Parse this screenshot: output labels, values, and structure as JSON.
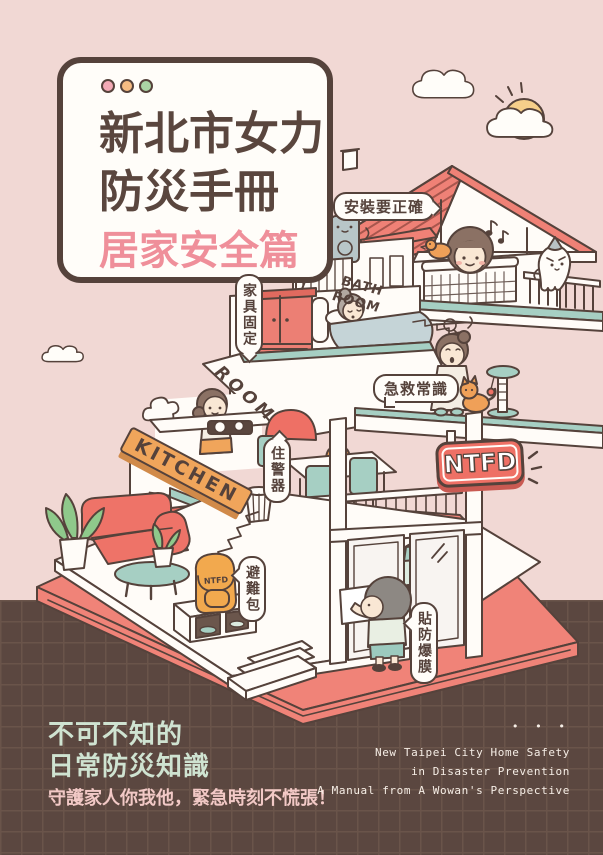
{
  "colors": {
    "background": "#f1d8d4",
    "footer_band": "#5b4740",
    "footer_grid": "#6a544a",
    "outline": "#55423b",
    "card_bg": "#fffdf9",
    "title_text": "#5a463e",
    "subtitle_text": "#ef8f9a",
    "roof_salmon": "#ef8176",
    "sign_red": "#ee7065",
    "teal": "#a6cfc3",
    "orange": "#f0a55b",
    "mint_text": "#cfe3d1",
    "pink_text": "#f2c9c6",
    "cream_text": "#f6eee6"
  },
  "title_card": {
    "window_dots": [
      "#f2a9b5",
      "#f5bb82",
      "#abd5a5"
    ],
    "line1": "新北市女力",
    "line2": "防災手冊",
    "line3": "居家安全篇"
  },
  "labels": {
    "install": "安裝要正確",
    "furniture_fix": "家具固定",
    "bath_room": "BATH\nROOM",
    "room": "ROOM",
    "first_aid": "急救常識",
    "kitchen": "KITCHEN",
    "home_alarm": "住警器",
    "ntfd_sign": "NTFD",
    "go_bag": "避難包",
    "blast_film": "貼防爆膜",
    "backpack_tag": "NTFD"
  },
  "footer": {
    "headline_line1": "不可不知的",
    "headline_line2": "日常防災知識",
    "tagline": "守護家人你我他，緊急時刻不慌張！",
    "ellipsis": "• • •",
    "english_line1": "New Taipei City Home Safety",
    "english_line2": "in Disaster Prevention",
    "english_line3": "A Manual from A Wowan's Perspective"
  }
}
